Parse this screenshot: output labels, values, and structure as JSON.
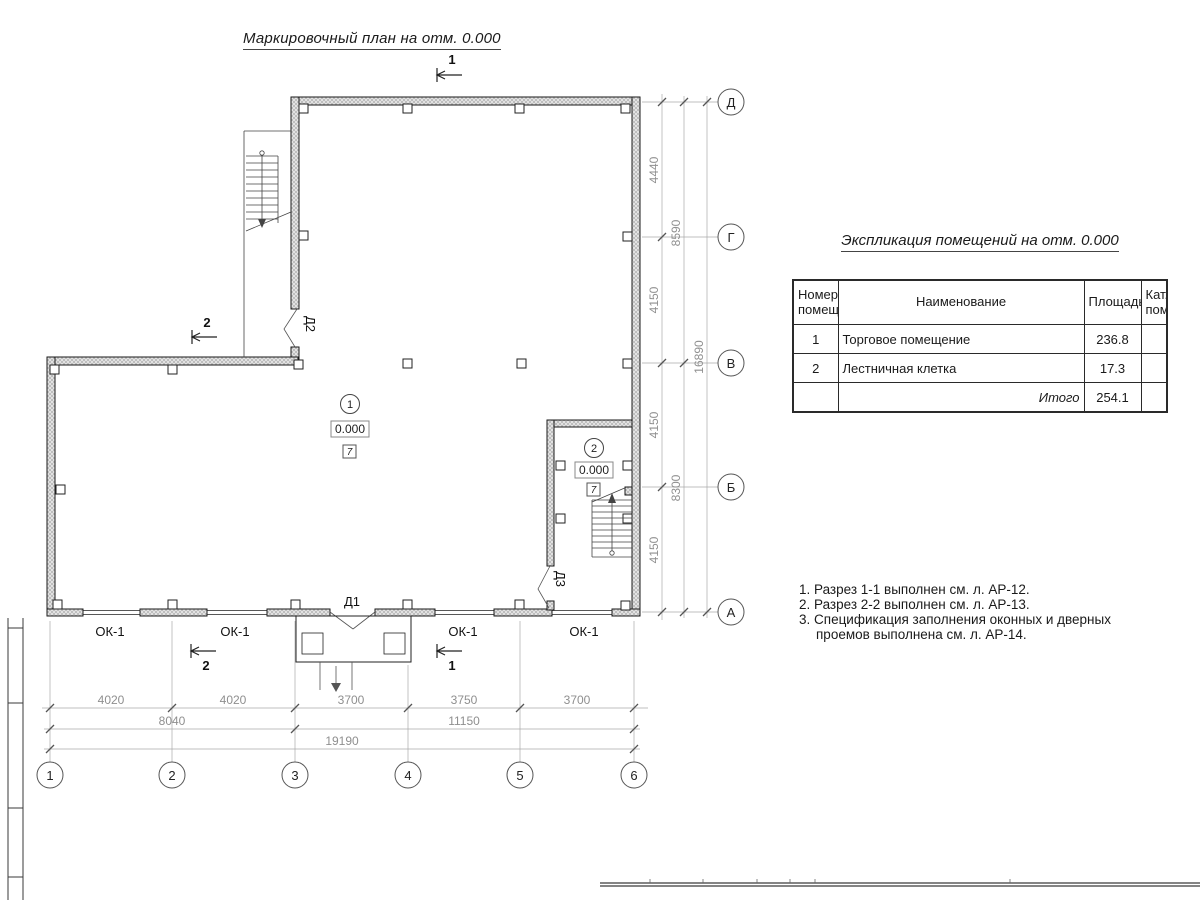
{
  "title": "Маркировочный план на отм. 0.000",
  "explication": {
    "title": "Экспликация помещений на отм. 0.000",
    "headers": {
      "num": "Номер помещ.",
      "name": "Наименование",
      "area": "Площадь",
      "cat": "Кат. пом."
    },
    "rows": [
      {
        "num": "1",
        "name": "Торговое помещение",
        "area": "236.8",
        "cat": ""
      },
      {
        "num": "2",
        "name": "Лестничная клетка",
        "area": "17.3",
        "cat": ""
      }
    ],
    "total_label": "Итого",
    "total_value": "254.1"
  },
  "notes": [
    "1. Разрез 1-1 выполнен см. л. АР-12.",
    "2. Разрез 2-2 выполнен см. л. АР-13.",
    "3. Спецификация заполнения оконных и дверных",
    "проемов выполнена см. л. АР-14."
  ],
  "axes": {
    "vertical": [
      "Д",
      "Г",
      "В",
      "Б",
      "А"
    ],
    "horizontal": [
      "1",
      "2",
      "3",
      "4",
      "5",
      "6"
    ]
  },
  "dimensions": {
    "right_inner": [
      "4440",
      "4150",
      "4150",
      "4150"
    ],
    "right_middle": [
      "8590",
      "8300"
    ],
    "right_total": "16890",
    "bottom_inner": [
      "4020",
      "4020",
      "3700",
      "3750",
      "3700"
    ],
    "bottom_middle": [
      "8040",
      "11150"
    ],
    "bottom_total": "19190"
  },
  "rooms": [
    {
      "number": "1",
      "level": "0.000",
      "floor_mark": "7"
    },
    {
      "number": "2",
      "level": "0.000",
      "floor_mark": "7"
    }
  ],
  "labels": {
    "window": "ОК-1",
    "door_d1": "Д1",
    "door_d2": "Д2",
    "door_d3": "Д3",
    "section_1": "1",
    "section_2": "2"
  }
}
